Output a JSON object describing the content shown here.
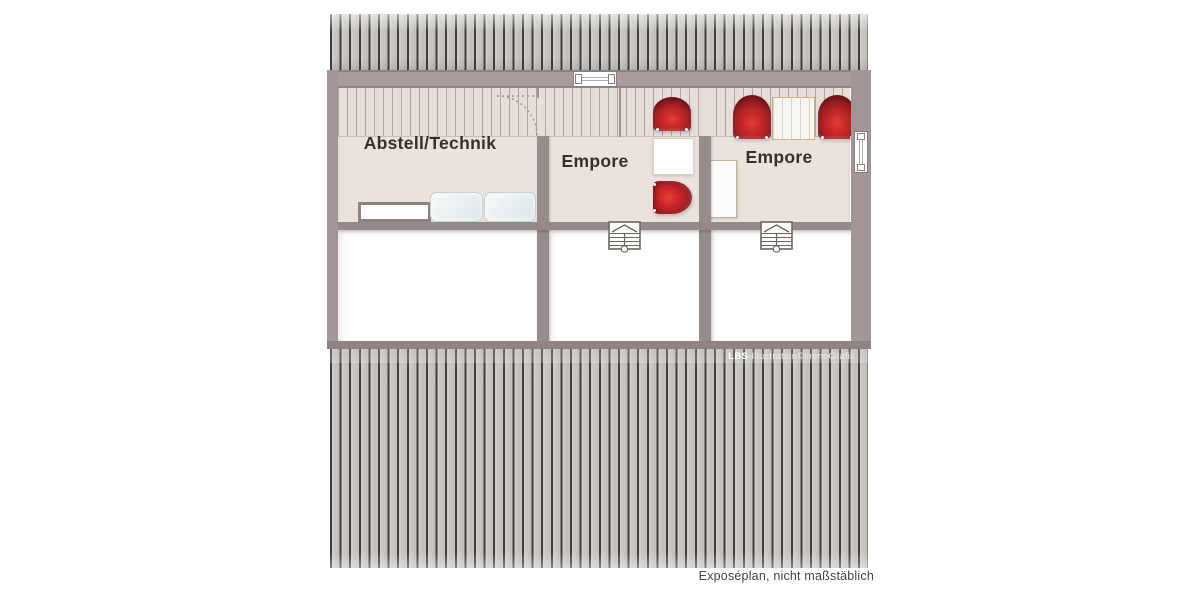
{
  "plan": {
    "rooms": {
      "abstell": {
        "label": "Abstell/Technik"
      },
      "empore_mid": {
        "label": "Empore"
      },
      "empore_right": {
        "label": "Empore"
      }
    },
    "watermark": {
      "brand": "LBS",
      "text": "-Illustration©immoGrafik"
    },
    "footer": {
      "note": "Exposéplan, nicht maßstäblich"
    },
    "colors": {
      "roof_stripe": "#403e3c",
      "roof_base": "#c9c6c2",
      "wall": "#9d9291",
      "floor_beige": "#eae2db",
      "chair_red": "#c52629",
      "sofa_blue": "#dde6e7"
    }
  }
}
